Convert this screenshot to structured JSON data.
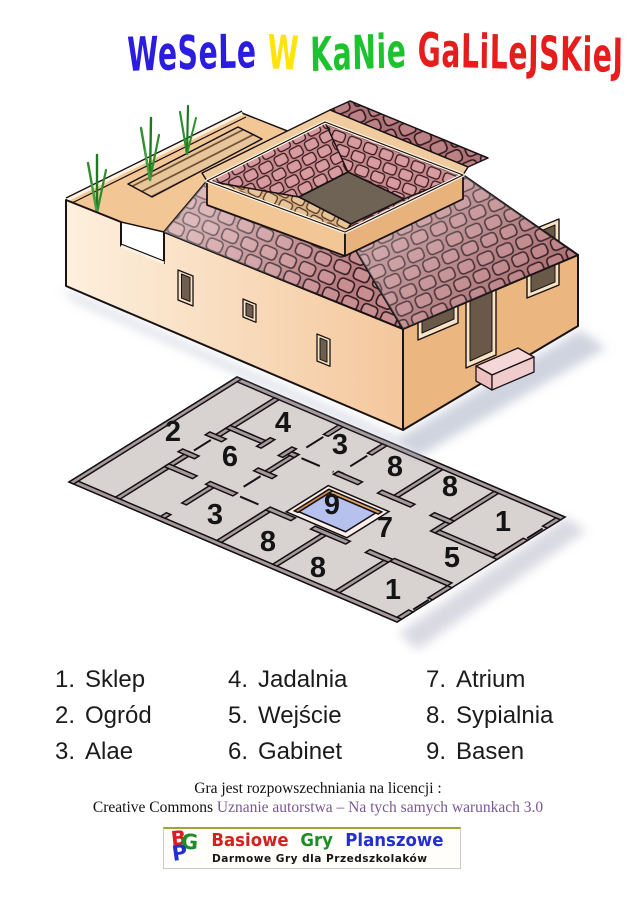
{
  "title": {
    "words": [
      {
        "text": "WeSeLe",
        "color": "#2a1de0"
      },
      {
        "text": "W",
        "color": "#ffe30a"
      },
      {
        "text": "KaNie",
        "color": "#1dc32e"
      },
      {
        "text": "GaLiLeJSKieJ",
        "color": "#e61d1d"
      }
    ]
  },
  "plan": {
    "labels": [
      "2",
      "4",
      "3",
      "8",
      "8",
      "1",
      "6",
      "9",
      "7",
      "3",
      "8",
      "8",
      "1",
      "5"
    ]
  },
  "legend": {
    "items": [
      {
        "num": "1.",
        "label": "Sklep"
      },
      {
        "num": "2.",
        "label": "Ogród"
      },
      {
        "num": "3.",
        "label": "Alae"
      },
      {
        "num": "4.",
        "label": "Jadalnia"
      },
      {
        "num": "5.",
        "label": "Wejście"
      },
      {
        "num": "6.",
        "label": "Gabinet"
      },
      {
        "num": "7.",
        "label": "Atrium"
      },
      {
        "num": "8.",
        "label": "Sypialnia"
      },
      {
        "num": "9.",
        "label": "Basen"
      }
    ]
  },
  "license": {
    "line1": "Gra jest rozpowszechniania na licencji :",
    "line2_prefix": "Creative Commons ",
    "line2_link": "Uznanie autorstwa – Na tych samych warunkach 3.0",
    "link_color": "#7a5894"
  },
  "logo": {
    "monogram": {
      "b": "B",
      "g": "G",
      "p": "P"
    },
    "words": [
      {
        "text": "Basiowe",
        "color": "#d42020"
      },
      {
        "text": "Gry",
        "color": "#1e8c28"
      },
      {
        "text": "Planszowe",
        "color": "#2330cc"
      }
    ],
    "subtitle": "Darmowe Gry dla Przedszkolaków"
  },
  "colors": {
    "roof_tile": "#b97d81",
    "wall_front": "#fbe9d2",
    "wall_side": "#ecb680",
    "plan_floor": "#d8d2d0",
    "plan_wall": "#a69a9a",
    "pool_water": "#b7c1ee",
    "pool_lip": "#dca05f",
    "plant_green": "#2f8f2f"
  }
}
